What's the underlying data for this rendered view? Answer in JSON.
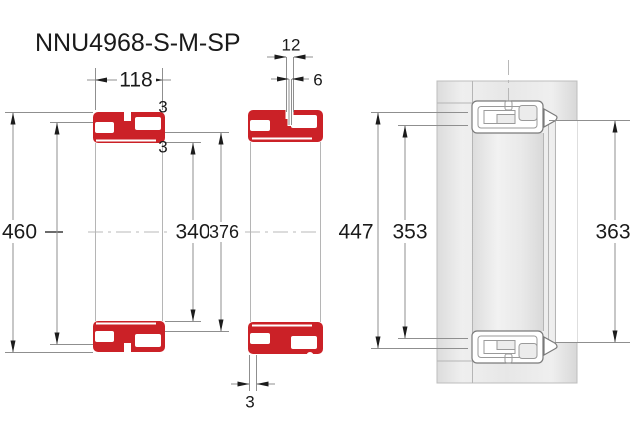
{
  "title": "NNU4968-S-M-SP",
  "colors": {
    "bearing_red": "#cb2127",
    "housing_gray": "#e9e9e9",
    "line_gray": "#8f8f8f",
    "text_black": "#1a1a1a"
  },
  "dimensions": {
    "width": "118",
    "groove_width": "12",
    "hole_diameter": "6",
    "flange_top": "3",
    "flange_top_inner": "3",
    "outer_diameter": "460",
    "bore_diameter": "340",
    "rib_diameter": "376",
    "groove_diameter": "447",
    "inner_rib_diameter": "353",
    "shoulder_diameter": "363",
    "flange_bottom": "3"
  }
}
